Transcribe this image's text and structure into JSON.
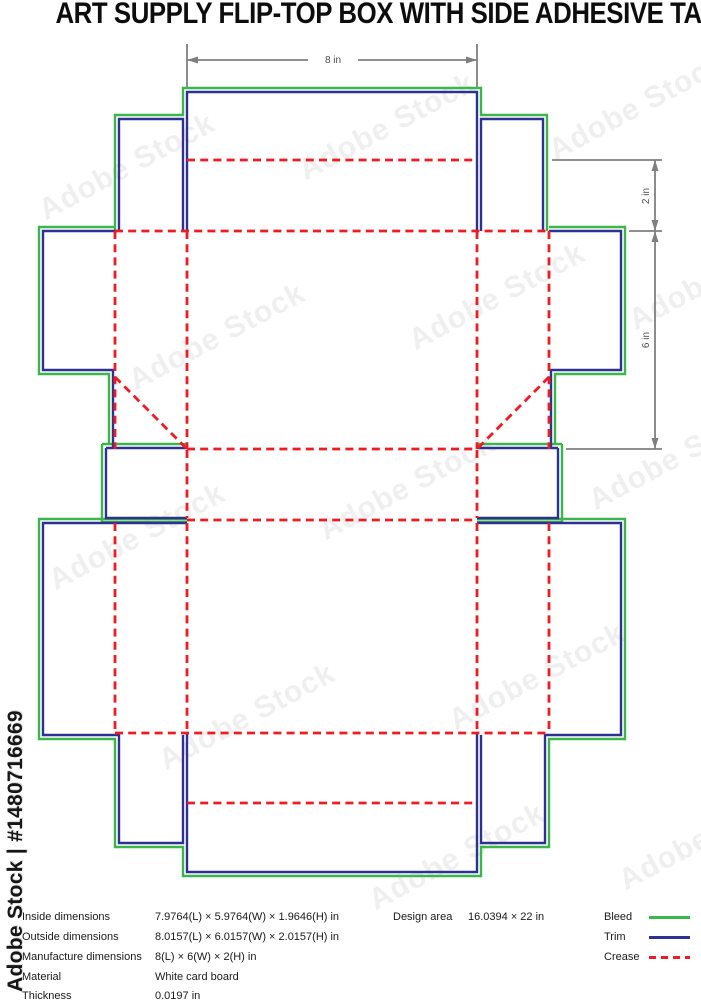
{
  "title": "ART SUPPLY FLIP-TOP BOX WITH SIDE ADHESIVE TABS",
  "watermark": {
    "vertical_text": "Adobe Stock | #1480716669",
    "diagonal_text": "Adobe Stock"
  },
  "dimension_labels": {
    "top": "8 in",
    "right_upper": "2 in",
    "right_lower": "6 in"
  },
  "legend": {
    "rows": [
      {
        "label": "Inside dimensions",
        "value": "7.9764(L) × 5.9764(W) × 1.9646(H) in"
      },
      {
        "label": "Outside dimensions",
        "value": "8.0157(L) × 6.0157(W) × 2.0157(H) in"
      },
      {
        "label": "Manufacture dimensions",
        "value": "8(L) × 6(W) × 2(H) in"
      },
      {
        "label": "Material",
        "value": "White card board"
      },
      {
        "label": "Thickness",
        "value": "0.0197 in"
      }
    ],
    "design_area": {
      "label": "Design area",
      "value": "16.0394 × 22 in"
    },
    "line_types": [
      {
        "label": "Bleed",
        "style": "solid-green"
      },
      {
        "label": "Trim",
        "style": "solid-blue"
      },
      {
        "label": "Crease",
        "style": "dashed-red"
      }
    ]
  },
  "colors": {
    "bleed": "#3cb54a",
    "trim": "#2e3192",
    "crease": "#ed1c24",
    "dim": "#7f7f7f"
  }
}
